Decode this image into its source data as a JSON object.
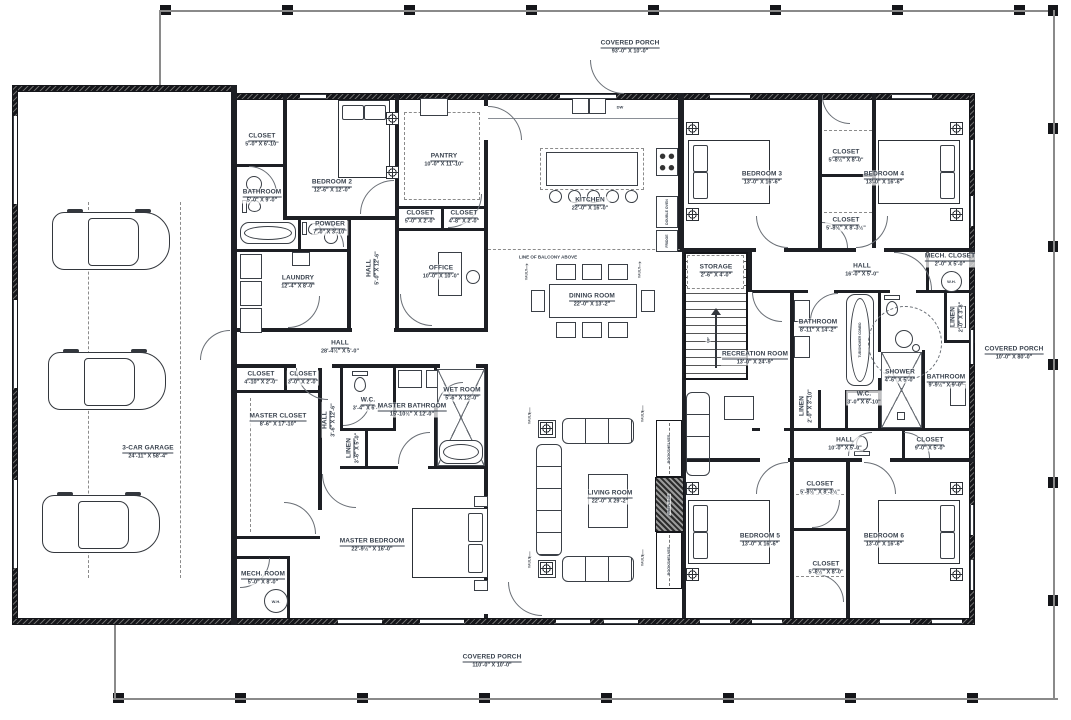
{
  "porches": {
    "top": {
      "name": "COVERED PORCH",
      "dims": "93'-0\" X 10'-0\""
    },
    "bottom": {
      "name": "COVERED PORCH",
      "dims": "110'-0\" X 10'-0\""
    },
    "right": {
      "name": "COVERED PORCH",
      "dims": "10'-0\" X 80'-0\""
    }
  },
  "rooms": {
    "garage": {
      "name": "3-CAR GARAGE",
      "dims": "24'-11\" X 58'-4\""
    },
    "closet_tl": {
      "name": "CLOSET",
      "dims": "5'-0\" X 6'-10\""
    },
    "bathroom_tl": {
      "name": "BATHROOM",
      "dims": "5'-0\" X 9'-0\""
    },
    "bedroom2": {
      "name": "BEDROOM 2",
      "dims": "12'-6\" X 12'-0\""
    },
    "powder": {
      "name": "POWDER",
      "dims": "7'-0\" X 3'-10\""
    },
    "laundry": {
      "name": "LAUNDRY",
      "dims": "12'-4\" X 8'-0\""
    },
    "hall_office": {
      "name": "HALL",
      "dims": "5'-0\" X 12'-6\""
    },
    "office": {
      "name": "OFFICE",
      "dims": "10'-0\" X 10'-0\""
    },
    "closet_off1": {
      "name": "CLOSET",
      "dims": "5'-0\" X 2'-0\""
    },
    "closet_off2": {
      "name": "CLOSET",
      "dims": "4'-8\" X 2'-0\""
    },
    "pantry": {
      "name": "PANTRY",
      "dims": "10'-0\" X 11'-10\""
    },
    "kitchen": {
      "name": "KITCHEN",
      "dims": "22'-0\" X 16'-0\""
    },
    "dining": {
      "name": "DINING ROOM",
      "dims": "22'-0\" X 13'-2\""
    },
    "hall_main": {
      "name": "HALL",
      "dims": "28'-4½\" X 5'-0\""
    },
    "closet_mh1": {
      "name": "CLOSET",
      "dims": "4'-10\" X 2'-0\""
    },
    "closet_mh2": {
      "name": "CLOSET",
      "dims": "3'-0\" X 2'-0\""
    },
    "master_closet": {
      "name": "MASTER CLOSET",
      "dims": "8'-6\" X 17'-10\""
    },
    "hall_master": {
      "name": "HALL",
      "dims": "3'-6\" X 12'-6\""
    },
    "wc_master": {
      "name": "W.C.",
      "dims": "3'-4\" X 6'-6\""
    },
    "master_bath": {
      "name": "MASTER BATHROOM",
      "dims": "15'-10½\" X 12'-0\""
    },
    "wet_room": {
      "name": "WET ROOM",
      "dims": "5'-6\" X 12'-0\""
    },
    "linen_master": {
      "name": "LINEN",
      "dims": "3'-6\" X 5'-0\""
    },
    "master_bedroom": {
      "name": "MASTER BEDROOM",
      "dims": "22'-9½\" X 16'-0\""
    },
    "mech_room": {
      "name": "MECH. ROOM",
      "dims": "5'-0\" X 8'-0\""
    },
    "living": {
      "name": "LIVING ROOM",
      "dims": "22'-0\" X 29'-2\""
    },
    "recreation": {
      "name": "RECREATION ROOM",
      "dims": "13'-0\" X 24'-9\""
    },
    "storage": {
      "name": "STORAGE",
      "dims": "2'-6\" X 4'-0\""
    },
    "bedroom3": {
      "name": "BEDROOM 3",
      "dims": "13'-0\" X 16'-6\""
    },
    "closet_b34_top": {
      "name": "CLOSET",
      "dims": "5'-8½\" X 8'-0\""
    },
    "bedroom4": {
      "name": "BEDROOM 4",
      "dims": "13'-0\" X 16'-6\""
    },
    "closet_b34_mid": {
      "name": "CLOSET",
      "dims": "5'-8½\" X 8'-3½\""
    },
    "hall_ne": {
      "name": "HALL",
      "dims": "16'-0\" X 5'-0\""
    },
    "mech_closet": {
      "name": "MECH. CLOSET",
      "dims": "2'-0\" X 5'-0\""
    },
    "bathroom_ne": {
      "name": "BATHROOM",
      "dims": "8'-11\" X 14'-2\""
    },
    "linen_ne": {
      "name": "LINEN",
      "dims": "2'-0\" X 3'-8\""
    },
    "shower": {
      "name": "SHOWER",
      "dims": "4'-6\" X 5'-0\""
    },
    "bathroom_e": {
      "name": "BATHROOM",
      "dims": "9'-9½\" X 9'-0\""
    },
    "wc_e": {
      "name": "W.C.",
      "dims": "3'-0\" X 6'-10\""
    },
    "linen_e": {
      "name": "LINEN",
      "dims": "2'-0\" X 3'-10\""
    },
    "hall_se": {
      "name": "HALL",
      "dims": "10'-0\" X 5'-0\""
    },
    "closet_se": {
      "name": "CLOSET",
      "dims": "9'-0\" X 5'-0\""
    },
    "closet_b56_top": {
      "name": "CLOSET",
      "dims": "5'-8½\" X 8'-3½\""
    },
    "bedroom5": {
      "name": "BEDROOM 5",
      "dims": "13'-0\" X 16'-6\""
    },
    "bedroom6": {
      "name": "BEDROOM 6",
      "dims": "13'-0\" X 16'-6\""
    },
    "closet_b56_bot": {
      "name": "CLOSET",
      "dims": "5'-8½\" X 8'-0\""
    }
  },
  "annotations": {
    "balcony": "LINE OF BALCONY ABOVE",
    "bookshelves": "BOOKSHELVES",
    "fireplace": "FIREPLACE",
    "tub_shower": "TUB/SHOWER COMBO",
    "double_oven": "DOUBLE OVEN",
    "fridge": "FRIDGE",
    "dw": "DW",
    "wh": "W.H.",
    "up": "UP",
    "vault": "VAULT"
  },
  "colors": {
    "wall": "#1d1f24",
    "text": "#39424e",
    "line": "#3a3f46"
  }
}
